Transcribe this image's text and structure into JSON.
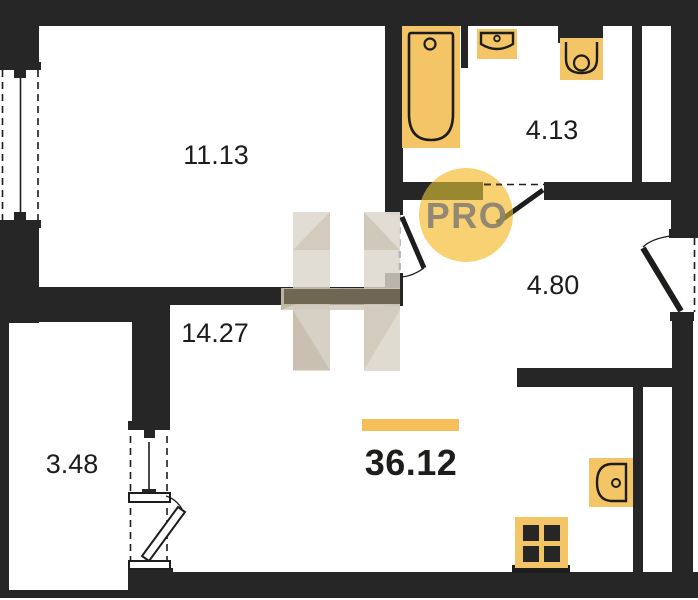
{
  "plan": {
    "title": "apartment-floor-plan",
    "total": {
      "value": "36.12"
    },
    "rooms": [
      {
        "id": "living-room",
        "label": "11.13"
      },
      {
        "id": "bathroom",
        "label": "4.13"
      },
      {
        "id": "hallway",
        "label": "4.80"
      },
      {
        "id": "kitchen-living",
        "label": "14.27"
      },
      {
        "id": "balcony",
        "label": "3.48"
      }
    ],
    "fixtures": [
      {
        "name": "bathtub-icon",
        "room": "bathroom"
      },
      {
        "name": "washbasin-icon",
        "room": "bathroom"
      },
      {
        "name": "toilet-icon",
        "room": "bathroom"
      },
      {
        "name": "kitchen-sink-icon",
        "room": "kitchen-living"
      },
      {
        "name": "stove-icon",
        "room": "kitchen-living"
      }
    ],
    "watermark": {
      "badge": "PRO",
      "letter": "H"
    },
    "colors": {
      "wall": "#262626",
      "fixture": "#F3C566",
      "fixture_outline": "#1D1D1B",
      "accent_bar": "#F5BF5A",
      "badge_bg": "#F8D173",
      "badge_text": "#8A8274",
      "watermark_beige": "#D6D0C5"
    }
  }
}
